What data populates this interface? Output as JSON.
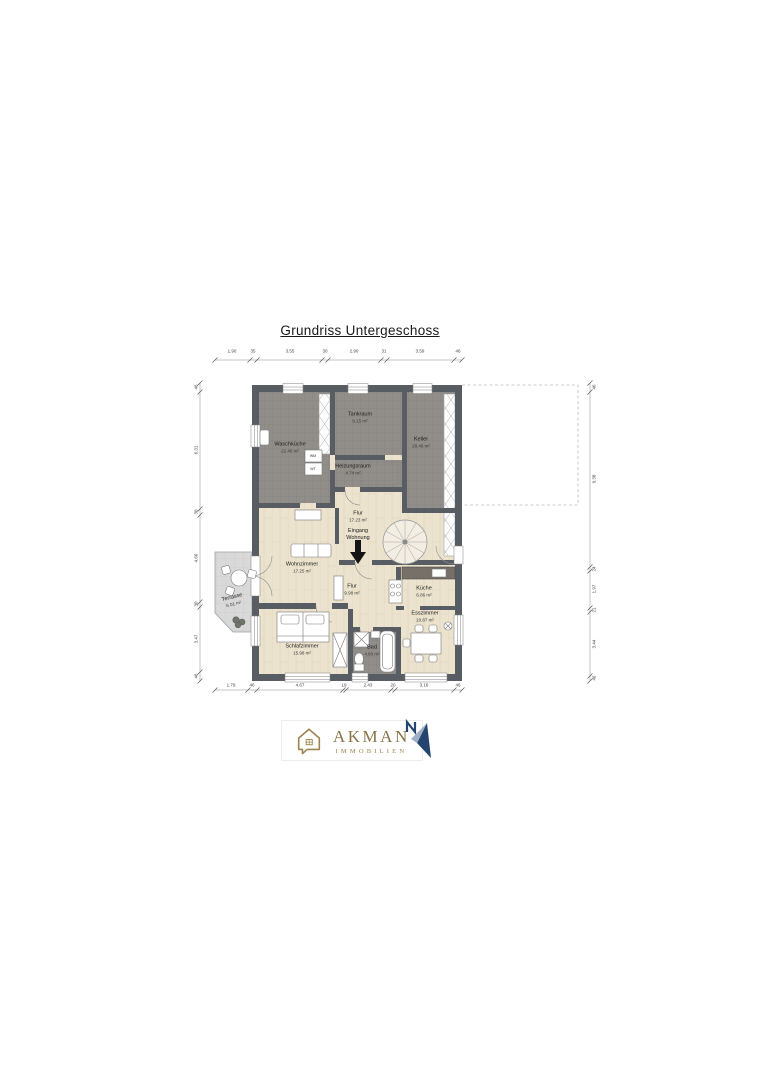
{
  "title": "Grundriss Untergeschoss",
  "rooms": {
    "waschkueche": {
      "name": "Waschküche",
      "area": "22.40 m²"
    },
    "tankraum": {
      "name": "Tankraum",
      "area": "9.15 m²"
    },
    "keller": {
      "name": "Keller",
      "area": "28.46 m²"
    },
    "heizungsraum": {
      "name": "Heizungsraum",
      "area": "4.74 m²"
    },
    "flur_oben": {
      "name": "Flur",
      "area": "17.23 m²"
    },
    "wohnzimmer": {
      "name": "Wohnzimmer",
      "area": "17.25 m²"
    },
    "terrasse": {
      "name": "Terrasse",
      "area": "6.01 m²"
    },
    "flur_unten": {
      "name": "Flur",
      "area": "9.98 m²"
    },
    "kueche": {
      "name": "Küche",
      "area": "6.86 m²"
    },
    "esszimmer": {
      "name": "Esszimmer",
      "area": "10.87 m²"
    },
    "schlafzimmer": {
      "name": "Schlafzimmer",
      "area": "15.98 m²"
    },
    "bad": {
      "name": "Bad",
      "area": "4.60 m²"
    }
  },
  "annotations": {
    "entrance_line1": "Eingang",
    "entrance_line2": "Wohnung"
  },
  "appliances": {
    "wm": "WM",
    "wt": "WT"
  },
  "dimensions": {
    "top": [
      "1.90",
      "35",
      "3.55",
      "30",
      "2.90",
      "31",
      "3.59",
      "46"
    ],
    "bottom": [
      "1.79",
      "46",
      "4.67",
      "19",
      "2.43",
      "20",
      "3.16",
      "46"
    ],
    "left": [
      "46",
      "6.31",
      "30",
      "4.66",
      "30",
      "3.47",
      "46"
    ],
    "right": [
      "46",
      "9.38",
      "24",
      "1.97",
      "21",
      "3.44",
      "46"
    ]
  },
  "logo": {
    "brand": "AKMAN",
    "subtitle": "IMMOBILIEN"
  },
  "colors": {
    "wall": "#585d64",
    "utility_floor": "#918e8a",
    "wood_floor": "#ece3cf",
    "terrace": "#d9d9d9",
    "logo_gold": "#9d854f",
    "north_blue": "#24456e"
  }
}
